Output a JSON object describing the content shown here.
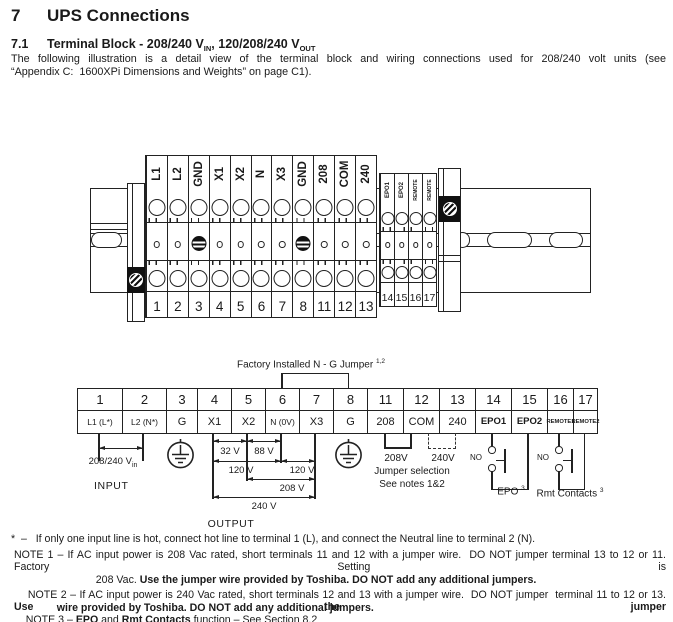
{
  "header": {
    "section_number": "7",
    "section_title": "UPS Connections",
    "subsection_number": "7.1",
    "subsection_t1": "Terminal Block - 208/240 V",
    "subsection_sub1": "IN",
    "subsection_t2": ", 120/208/240 V",
    "subsection_sub2": "OUT",
    "intro_line1": "The following illustration is a detail view of the terminal block and wiring connections used for 208/240 volt units (see",
    "intro_line2": "“Appendix C:  1600XPi Dimensions and Weights” on page C1)."
  },
  "upper_diagram": {
    "main_terminals": [
      {
        "label": "L1",
        "number": "1"
      },
      {
        "label": "L2",
        "number": "2"
      },
      {
        "label": "GND",
        "number": "3"
      },
      {
        "label": "X1",
        "number": "4"
      },
      {
        "label": "X2",
        "number": "5"
      },
      {
        "label": "N",
        "number": "6"
      },
      {
        "label": "X3",
        "number": "7"
      },
      {
        "label": "GND",
        "number": "8"
      },
      {
        "label": "208",
        "number": "11"
      },
      {
        "label": "COM",
        "number": "12"
      },
      {
        "label": "240",
        "number": "13"
      }
    ],
    "aux_terminals": [
      {
        "label": "EPO1",
        "number": "14"
      },
      {
        "label": "EPO2",
        "number": "15"
      },
      {
        "label": "REMOTE",
        "number": "16"
      },
      {
        "label": "REMOTE",
        "number": "17"
      }
    ]
  },
  "lower_diagram": {
    "factory_jumper_label": "Factory Installed N - G Jumper",
    "factory_jumper_sup": "1,2",
    "columns": [
      {
        "number": "1",
        "label": "L1 (L*)"
      },
      {
        "number": "2",
        "label": "L2 (N*)"
      },
      {
        "number": "3",
        "label": "G"
      },
      {
        "number": "4",
        "label": "X1"
      },
      {
        "number": "5",
        "label": "X2"
      },
      {
        "number": "6",
        "label": "N (0V)"
      },
      {
        "number": "7",
        "label": "X3"
      },
      {
        "number": "8",
        "label": "G"
      },
      {
        "number": "11",
        "label": "208"
      },
      {
        "number": "12",
        "label": "COM"
      },
      {
        "number": "13",
        "label": "240"
      },
      {
        "number": "14",
        "label": "EPO1"
      },
      {
        "number": "15",
        "label": "EPO2"
      },
      {
        "number": "16",
        "label": "REMOTE1"
      },
      {
        "number": "17",
        "label": "REMOTE2"
      }
    ],
    "input_voltage": "208/240 V",
    "input_voltage_sub": "in",
    "input_label": "INPUT",
    "dims": {
      "d32": "32 V",
      "d88": "88 V",
      "d120a": "120 V",
      "d120b": "120 V",
      "d208": "208 V",
      "d240": "240 V"
    },
    "output_label": "OUTPUT",
    "jumper_208": "208V",
    "jumper_240": "240V",
    "jumper_line1": "Jumper selection",
    "jumper_line2": "See notes 1&2",
    "epo_no": "NO",
    "epo_label": "EPO",
    "epo_sup": "3",
    "rmt_no": "NO",
    "rmt_label": "Rmt Contacts",
    "rmt_sup": "3"
  },
  "notes": {
    "star_line": "*  –   If only one input line is hot, connect hot line to terminal 1 (L), and connect the Neutral line to terminal 2 (N).",
    "note1_l1": "NOTE 1 – If AC input power is 208 Vac rated, short terminals 11 and 12 with a jumper wire.  DO NOT jumper terminal 13 to 12 or 11.  Factory Setting is",
    "note1_l2a": "208 Vac. ",
    "note1_l2b": "Use the jumper wire provided by Toshiba. DO NOT add any additional jumpers.",
    "note2_l1a": "NOTE 2 – If AC input power is 240 Vac rated, short terminals 12 and 13 with a jumper wire.  DO NOT jumper  terminal 11 to 12 or 13.  ",
    "note2_l1b": "Use the jumper",
    "note2_l2": "wire provided by Toshiba. DO NOT add any additional jumpers.",
    "note3_a": "NOTE 3 – ",
    "note3_b": "EPO",
    "note3_c": " and ",
    "note3_d": "Rmt Contacts",
    "note3_e": " function – See Section 8.2"
  }
}
